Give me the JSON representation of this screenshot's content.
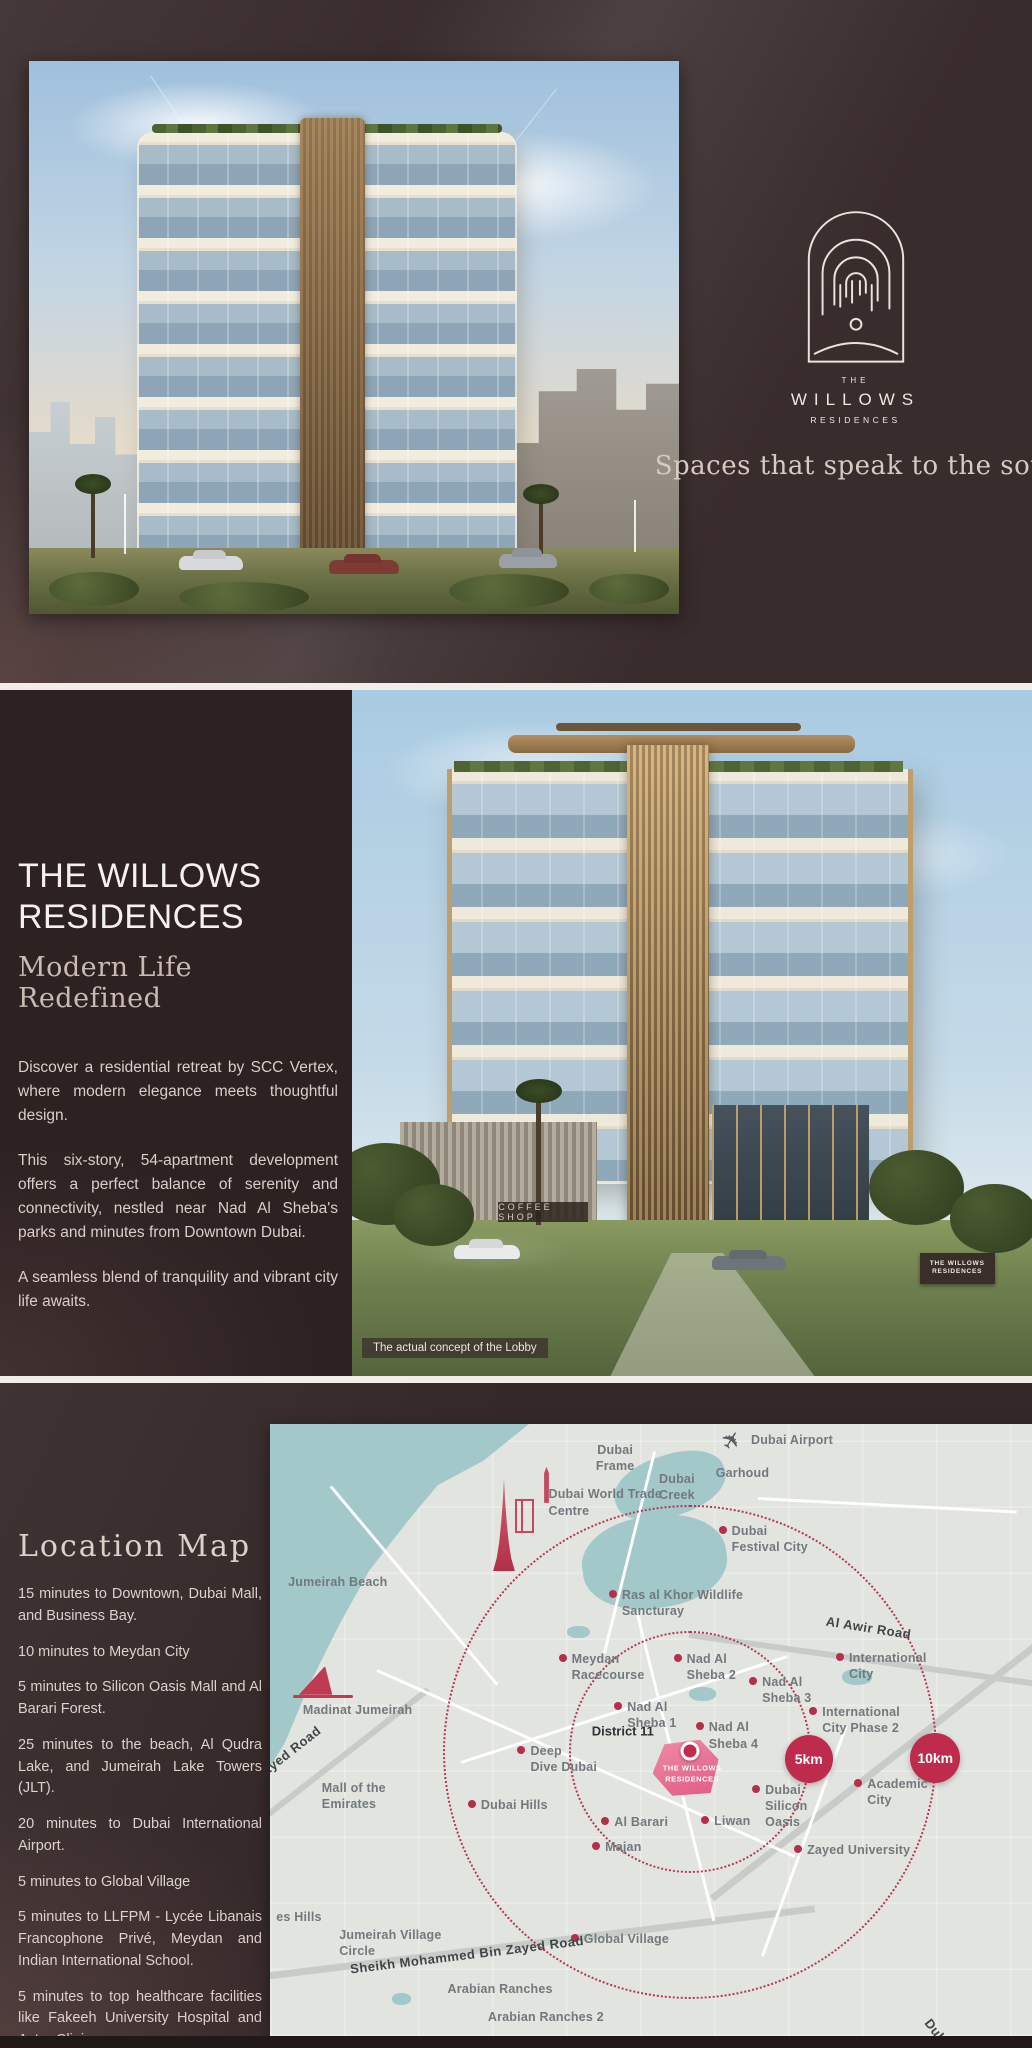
{
  "brand": {
    "logo_the": "THE",
    "logo_willows": "WILLOWS",
    "logo_residences": "RESIDENCES",
    "tagline": "Spaces that speak to the soul"
  },
  "intro": {
    "title": "THE WILLOWS\nRESIDENCES",
    "subtitle": "Modern Life Redefined",
    "paragraphs": [
      "Discover a residential retreat by SCC Vertex, where modern elegance meets thoughtful design.",
      "This six-story, 54-apartment development offers a perfect balance of serenity and connectivity, nestled near Nad Al Sheba's parks and minutes from Downtown Dubai.",
      "A seamless blend of tranquility and vibrant city life awaits."
    ],
    "coffee_sign": "COFFEE SHOP",
    "building_board": "THE WILLOWS\nRESIDENCES",
    "photo_caption": "The actual concept of the Lobby"
  },
  "location": {
    "heading": "Location Map",
    "items": [
      "15 minutes to Downtown, Dubai Mall, and Business Bay.",
      "10 minutes to Meydan City",
      "5 minutes to Silicon Oasis Mall and Al Barari Forest.",
      "25 minutes to the beach, Al Qudra Lake, and Jumeirah Lake Towers (JLT).",
      "20 minutes to Dubai International Airport.",
      "5 minutes to Global Village",
      "5 minutes to LLFPM - Lycée Libanais Francophone Privé, Meydan and Indian International School.",
      "5 minutes to top healthcare facilities like Fakeeh University Hospital and Aster Clinic."
    ]
  },
  "map": {
    "district_label": "District 11",
    "project_name": "THE WILLOWS\nRESIDENCES",
    "km_inner": "5km",
    "km_outer": "10km",
    "accent_red": "#bf2b4d",
    "water_teal": "#a3c8ca",
    "plane_icon": "✈",
    "labels": [
      {
        "id": "dubai-frame",
        "type": "area",
        "x": 45.3,
        "y": 5.5,
        "lines": [
          "Dubai",
          "Frame"
        ]
      },
      {
        "id": "dubai-world-trade-centre",
        "type": "area",
        "x": 44.0,
        "y": 12.8,
        "align": "left",
        "lines": [
          "Dubai World Trade",
          "Centre"
        ]
      },
      {
        "id": "dubai-creek",
        "type": "area",
        "x": 53.4,
        "y": 10.3,
        "align": "left",
        "lines": [
          "Dubai",
          "Creek"
        ]
      },
      {
        "id": "garhoud",
        "type": "area",
        "x": 62.0,
        "y": 8.0,
        "lines": [
          "Garhoud"
        ]
      },
      {
        "id": "dubai-airport",
        "type": "area",
        "x": 68.5,
        "y": 2.6,
        "lines": [
          "Dubai Airport"
        ]
      },
      {
        "id": "dubai-festival-city",
        "type": "poi",
        "x": 59.4,
        "y": 17.3,
        "lines": [
          "Dubai",
          "Festival City"
        ]
      },
      {
        "id": "ras-al-khor-wildlife-sancturay",
        "type": "poi",
        "x": 45.0,
        "y": 27.8,
        "lines": [
          "Ras al Khor Wildlife",
          "Sancturay"
        ]
      },
      {
        "id": "meydan-racecourse",
        "type": "poi",
        "x": 38.4,
        "y": 38.2,
        "lines": [
          "Meydan",
          "Racecourse"
        ]
      },
      {
        "id": "nad-al-sheba-2",
        "type": "poi",
        "x": 53.5,
        "y": 38.2,
        "lines": [
          "Nad Al",
          "Sheba 2"
        ]
      },
      {
        "id": "nad-al-sheba-3",
        "type": "poi",
        "x": 63.4,
        "y": 42.0,
        "lines": [
          "Nad Al",
          "Sheba 3"
        ]
      },
      {
        "id": "nad-al-sheba-1",
        "type": "poi",
        "x": 45.7,
        "y": 46.0,
        "lines": [
          "Nad Al",
          "Sheba 1"
        ]
      },
      {
        "id": "nad-al-sheba-4",
        "type": "poi",
        "x": 56.4,
        "y": 49.4,
        "lines": [
          "Nad Al",
          "Sheba 4"
        ]
      },
      {
        "id": "deep-dive-dubai",
        "type": "poi",
        "x": 33.0,
        "y": 53.3,
        "lines": [
          "Deep",
          "Dive Dubai"
        ]
      },
      {
        "id": "international-city",
        "type": "poi",
        "x": 74.8,
        "y": 38.1,
        "lines": [
          "International",
          "City"
        ]
      },
      {
        "id": "international-city-phase-2",
        "type": "poi",
        "x": 71.3,
        "y": 46.9,
        "lines": [
          "International",
          "City Phase 2"
        ]
      },
      {
        "id": "academic-city",
        "type": "poi",
        "x": 77.2,
        "y": 58.7,
        "lines": [
          "Academic",
          "City"
        ]
      },
      {
        "id": "zayed-university",
        "type": "poi",
        "x": 69.3,
        "y": 69.5,
        "lines": [
          "Zayed University"
        ]
      },
      {
        "id": "dubai-hills",
        "type": "poi",
        "x": 26.5,
        "y": 62.1,
        "lines": [
          "Dubai Hills"
        ]
      },
      {
        "id": "al-barari",
        "type": "poi",
        "x": 44.0,
        "y": 64.9,
        "lines": [
          "Al Barari"
        ]
      },
      {
        "id": "majan",
        "type": "poi",
        "x": 42.8,
        "y": 69.0,
        "lines": [
          "Majan"
        ]
      },
      {
        "id": "liwan",
        "type": "poi",
        "x": 57.1,
        "y": 64.7,
        "lines": [
          "Liwan"
        ]
      },
      {
        "id": "dubai-silicon-oasis",
        "type": "poi",
        "x": 63.8,
        "y": 59.6,
        "lines": [
          "Dubai",
          "Silicon",
          "Oasis"
        ]
      },
      {
        "id": "global-village",
        "type": "poi",
        "x": 40.0,
        "y": 84.0,
        "lines": [
          "Global Village"
        ]
      },
      {
        "id": "jumeirah-beach",
        "type": "area",
        "x": 8.9,
        "y": 25.8,
        "lines": [
          "Jumeirah Beach"
        ]
      },
      {
        "id": "madinat-jumeirah",
        "type": "area",
        "x": 11.5,
        "y": 46.8,
        "lines": [
          "Madinat Jumeirah"
        ]
      },
      {
        "id": "mall-of-the-emirates",
        "type": "area",
        "x": 11.0,
        "y": 60.8,
        "align": "left",
        "lines": [
          "Mall of the",
          "Emirates"
        ]
      },
      {
        "id": "es-hills",
        "type": "area",
        "x": 3.8,
        "y": 80.5,
        "lines": [
          "es Hills"
        ]
      },
      {
        "id": "jumeirah-village-circle",
        "type": "area",
        "x": 15.8,
        "y": 84.8,
        "align": "left",
        "lines": [
          "Jumeirah Village",
          "Circle"
        ]
      },
      {
        "id": "arabian-ranches",
        "type": "area",
        "x": 30.2,
        "y": 92.3,
        "lines": [
          "Arabian Ranches"
        ]
      },
      {
        "id": "arabian-ranches-2",
        "type": "area",
        "x": 36.2,
        "y": 96.9,
        "lines": [
          "Arabian Ranches 2"
        ]
      },
      {
        "id": "al-awir-road",
        "type": "road",
        "x": 78.6,
        "y": 32.3,
        "rot": 9,
        "lines": [
          "Al Awir Road"
        ]
      },
      {
        "id": "zayed-road",
        "type": "road",
        "x": 3.6,
        "y": 57.8,
        "rot": -38,
        "lines": [
          "Zayed Road"
        ]
      },
      {
        "id": "sheikh-mohammed-bin-zayed-road",
        "type": "road",
        "x": 26.0,
        "y": 89.2,
        "rot": -7,
        "lines": [
          "Sheikh Mohammed Bin Zayed Road"
        ]
      },
      {
        "id": "dubai-road-edge",
        "type": "road",
        "x": 88.5,
        "y": 97.6,
        "rot": 52,
        "lines": [
          "Duba"
        ]
      }
    ]
  }
}
